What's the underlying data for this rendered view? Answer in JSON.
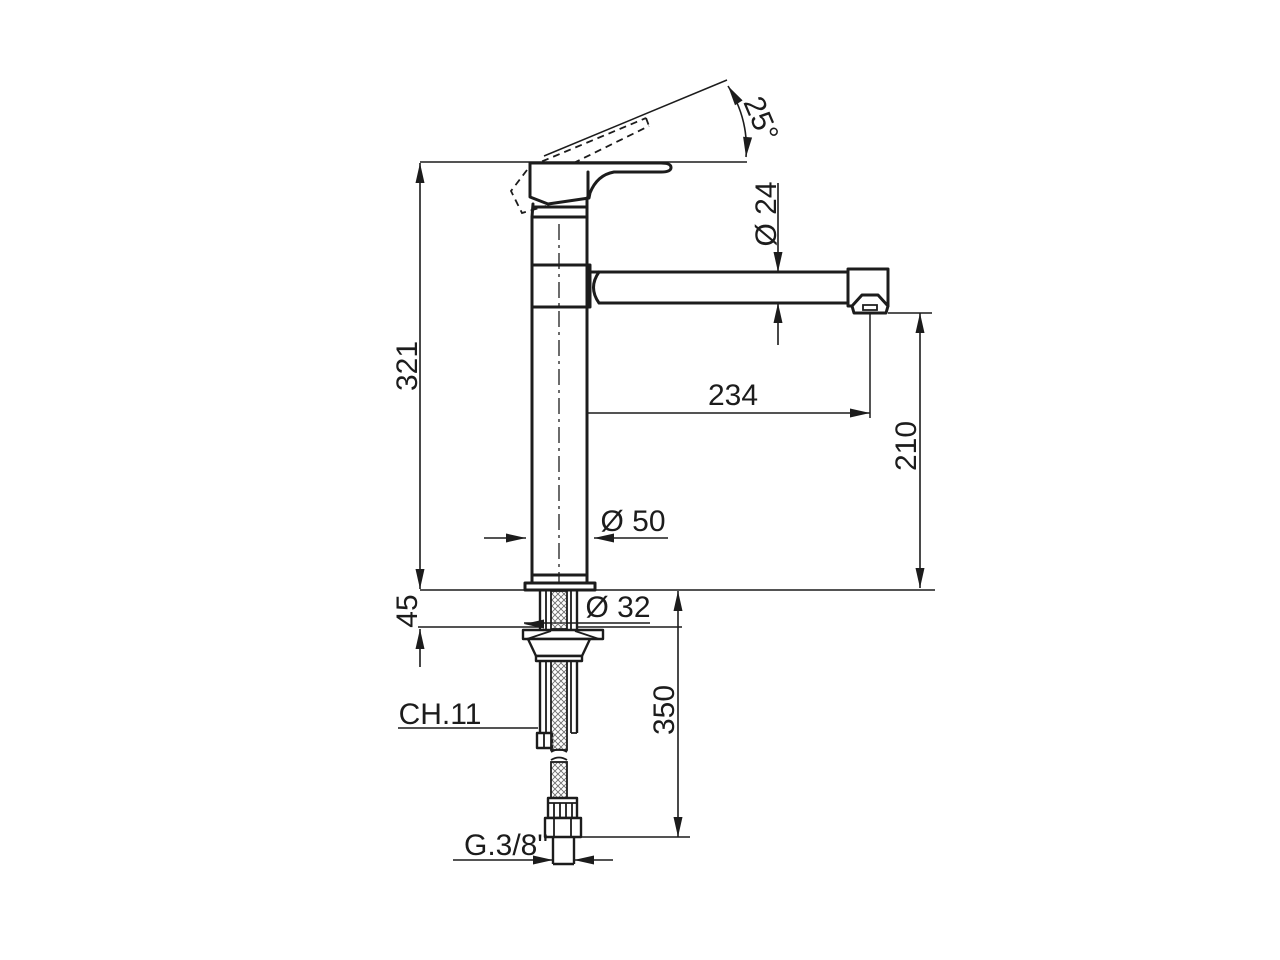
{
  "canvas": {
    "background": "#ffffff",
    "line_color": "#1c1c1c"
  },
  "labels": {
    "handle_angle": "25°",
    "total_height": "321",
    "spout_tube_diameter": "Ø 24",
    "spout_reach": "234",
    "spout_outlet_height": "210",
    "body_base_diameter": "Ø 50",
    "deck_thickness": "45",
    "mounting_hole_diameter": "Ø 32",
    "wrench_size": "CH.11",
    "hose_length": "350",
    "connection_thread": "G.3/8\""
  }
}
